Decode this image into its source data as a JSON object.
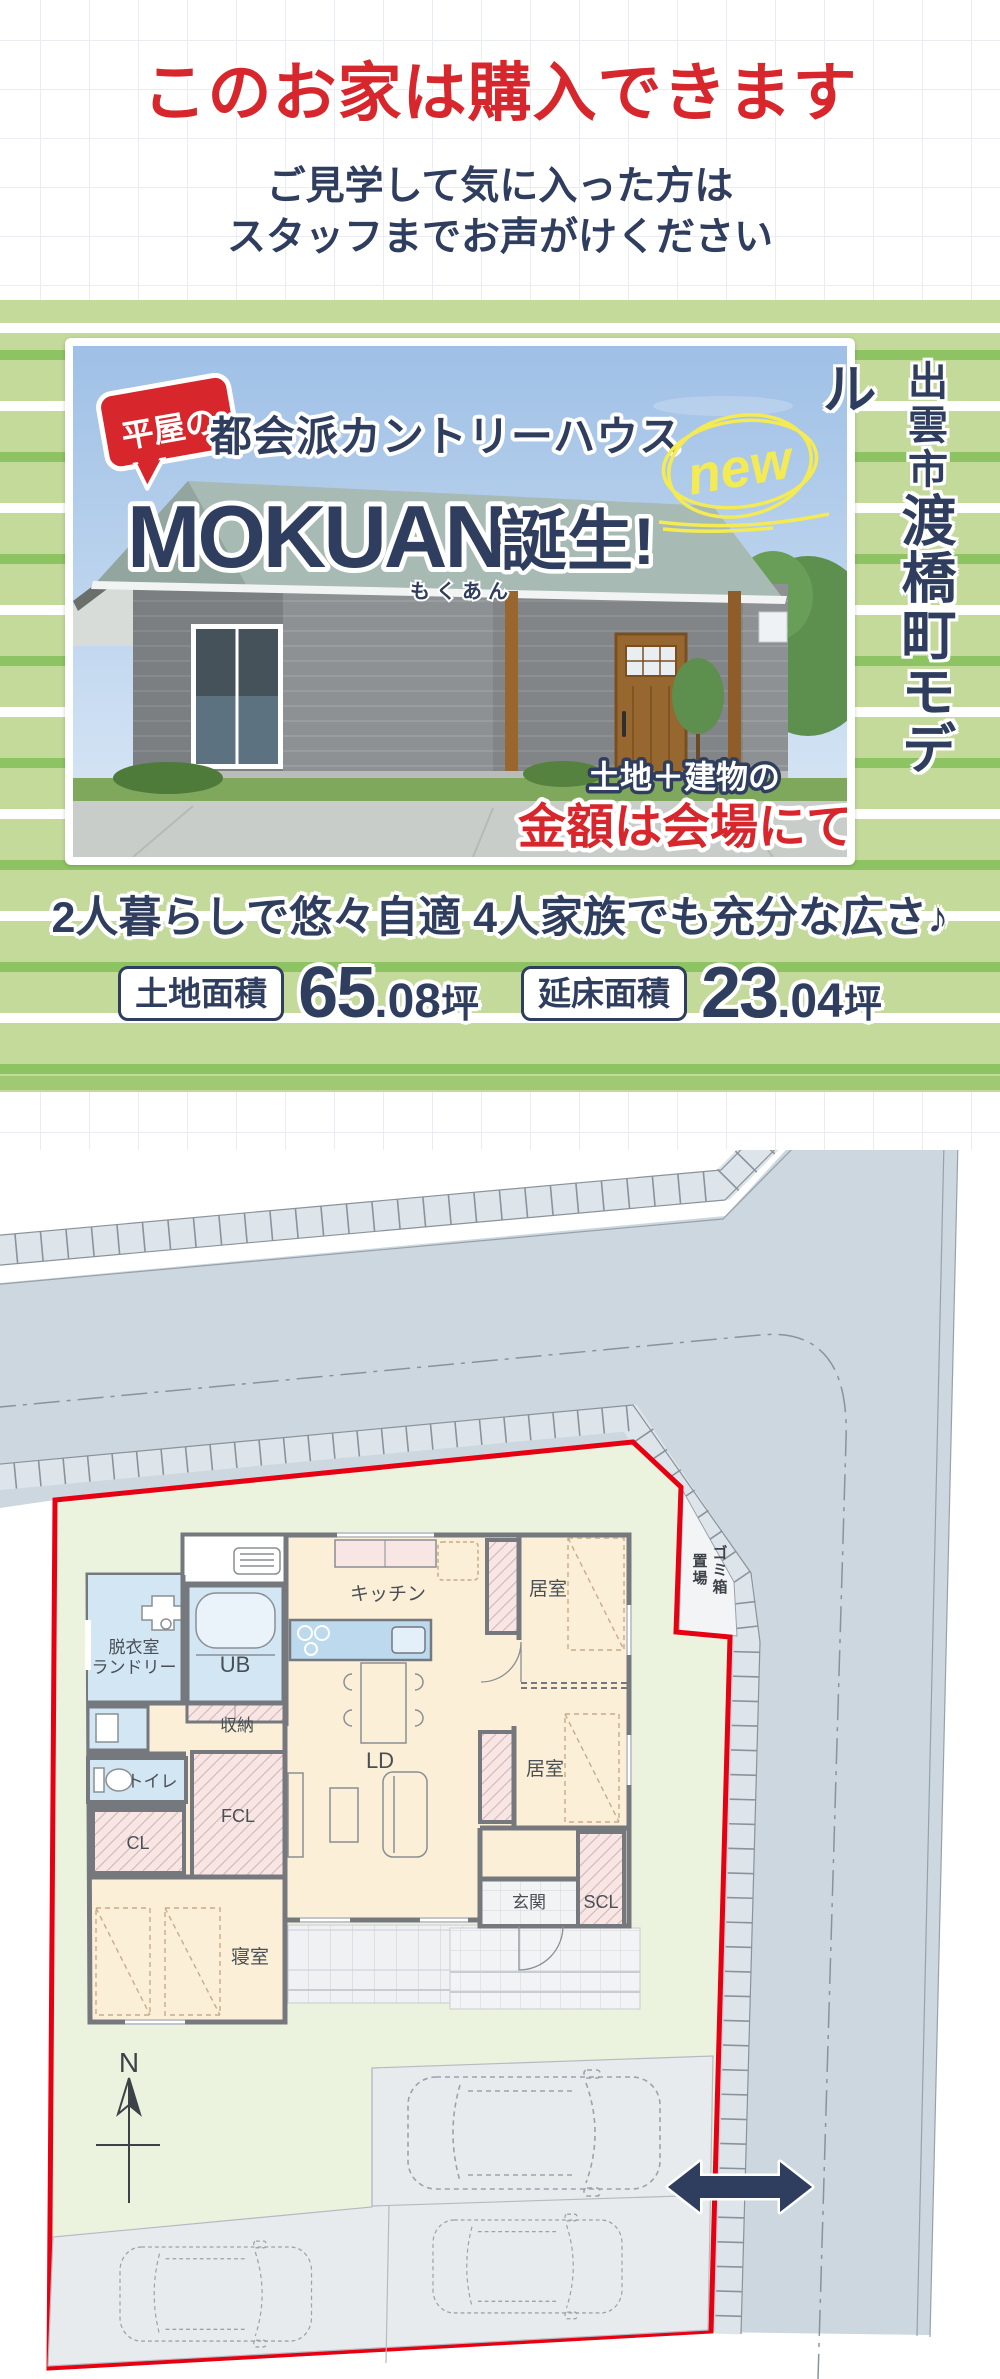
{
  "theme": {
    "red": "#d7262c",
    "navy": "#2f3e5e",
    "green-light": "#c3da9b",
    "green-stripe": "#8ec363",
    "lot-red": "#e60012",
    "road-fill": "#ccd7df",
    "lot-green": "#ebf2de",
    "yellow-new": "#f3ea54"
  },
  "header": {
    "title": "このお家は購入できます",
    "subtitle_line1": "ご見学して気に入った方は",
    "subtitle_line2": "スタッフまでお声がけください"
  },
  "hero": {
    "badge": "平屋の",
    "series": "都会派カントリーハウス",
    "product_name": "MOKUAN",
    "product_suffix": "誕生!",
    "furigana": "もくあん",
    "new_label": "new",
    "price_note_line1": "土地＋建物の",
    "price_note_line2": "金額は会場にて",
    "location_city": "出雲市",
    "location_model": "渡橋町モデル"
  },
  "specs": {
    "catchcopy": "2人暮らしで悠々自適 4人家族でも充分な広さ♪",
    "land_label": "土地面積",
    "land_value": "65",
    "land_decimal": ".08",
    "land_unit": "坪",
    "floor_label": "延床面積",
    "floor_value": "23",
    "floor_decimal": ".04",
    "floor_unit": "坪"
  },
  "siteplan": {
    "compass": "N",
    "garbage_col1": [
      "ゴ",
      "ミ",
      "箱"
    ],
    "garbage_col2": [
      "置",
      "場"
    ],
    "rooms": {
      "datsui1": "脱衣室",
      "datsui2": "ランドリー",
      "ub": "UB",
      "shuno": "収納",
      "kitchen": "キッチン",
      "kyoshitsu1": "居室",
      "kyoshitsu2": "居室",
      "toilet": "トイレ",
      "cl": "CL",
      "fcl": "FCL",
      "ld": "LD",
      "bedroom": "寝室",
      "genkan": "玄関",
      "scl": "SCL"
    }
  }
}
